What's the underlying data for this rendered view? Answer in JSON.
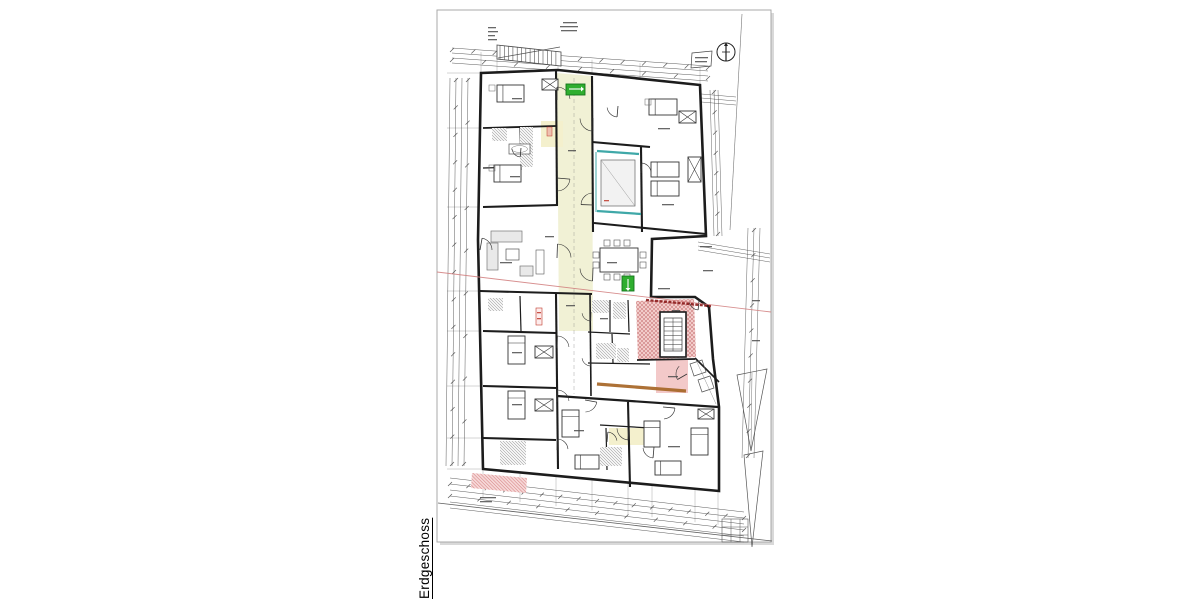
{
  "sheet": {
    "floor_label": "Erdgeschoss"
  },
  "icons": {
    "north_arrow": "north-arrow-icon",
    "exit_sign": "exit-sign-icon",
    "stair": "stair-icon",
    "elevator": "elevator-icon"
  },
  "colors": {
    "paper": "#ffffff",
    "page_border": "#a9a9a9",
    "page_shadow": "#d9d9d9",
    "wall": "#1c1c1c",
    "dim": "#4a4a4a",
    "site": "#555555",
    "corridor": "#f1f1d5",
    "bath_yellow": "#f4f0cd",
    "stair_fill": "#f2ccca",
    "stair_hatch": "#c2696b",
    "pink": "#f3c9c9",
    "pink_band": "#f6d8d8",
    "pink_hatch": "#d98c8c",
    "green": "#2fae2f",
    "green_dark": "#15741c",
    "teal": "#3fa8a8",
    "brown": "#a96a2c",
    "fire_band": "#8b1a1a",
    "survey_line": "#d17c7c",
    "red_label": "#c0392b",
    "fixture": "#8d8d8d",
    "furniture": "#e9e9e9",
    "text_mark": "#4d4d4d"
  }
}
